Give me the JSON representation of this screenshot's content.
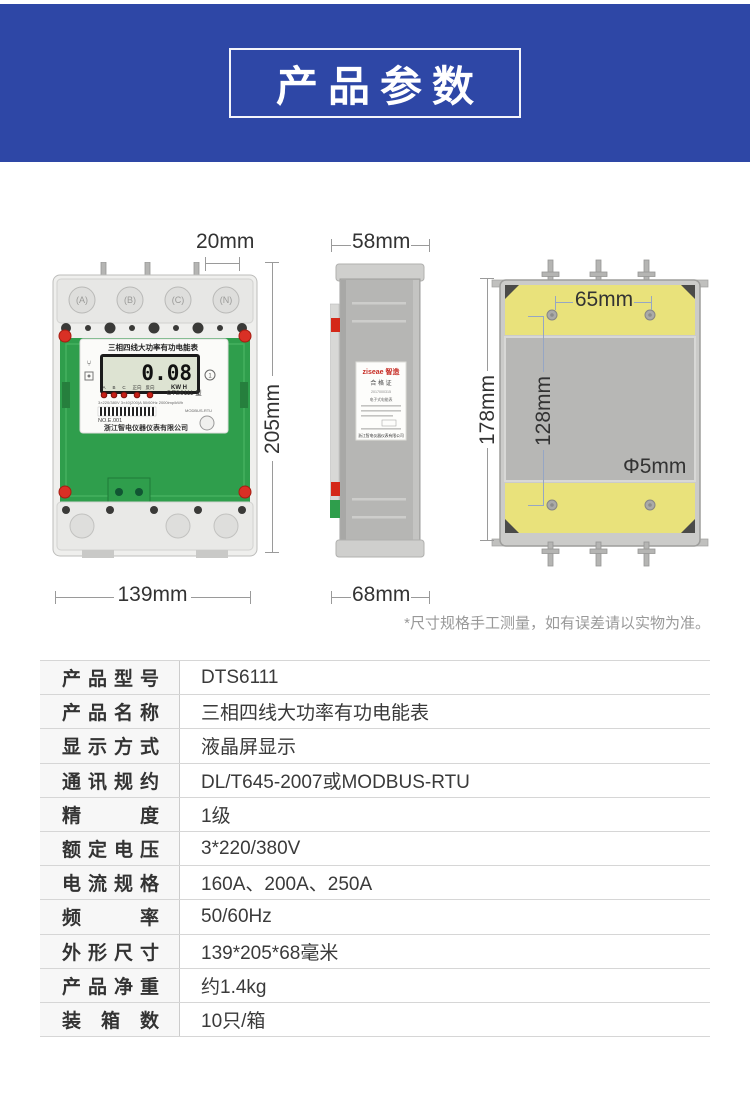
{
  "header": {
    "title": "产品参数",
    "bg_color": "#2e47a6"
  },
  "diagram": {
    "front_view": {
      "terminal_labels": [
        "A",
        "B",
        "C",
        "N"
      ],
      "meter_title": "三相四线大功率有功电能表",
      "lcd_value": "0.08",
      "lcd_unit": "KW H",
      "register_badge": "1",
      "indicator_labels": [
        "A",
        "B",
        "C",
        "正向",
        "反向"
      ],
      "model_label": "DTS6111 型",
      "spec_line": "3×220/380V 3×40(200)A 50/60Hz 2000imp/kWh",
      "comm_line": "MODBUS-RTU",
      "serial_no": "NO.E.001",
      "company": "浙江智电仪器仪表有限公司"
    },
    "side_view": {
      "brand": "ziseae 智造",
      "cert_title": "合 格 证",
      "cert_no": "2017000315",
      "cert_item": "电子式电能表",
      "cert_company": "浙江智电仪器仪表有限公司"
    },
    "dimensions": {
      "top_pitch": "20mm",
      "depth_body": "58mm",
      "hole_pitch_h": "65mm",
      "height_front": "205mm",
      "height_back": "178mm",
      "hole_pitch_v": "128mm",
      "hole_dia": "Φ5mm",
      "width_front": "139mm",
      "depth_base": "68mm"
    },
    "note": "*尺寸规格手工测量，如有误差请以实物为准。"
  },
  "spec_table": {
    "rows": [
      {
        "label": "产品型号",
        "value": "DTS6111"
      },
      {
        "label": "产品名称",
        "value": "三相四线大功率有功电能表"
      },
      {
        "label": "显示方式",
        "value": "液晶屏显示"
      },
      {
        "label": "通讯规约",
        "value": "DL/T645-2007或MODBUS-RTU"
      },
      {
        "label": "精度",
        "value": "1级"
      },
      {
        "label": "额定电压",
        "value": "3*220/380V"
      },
      {
        "label": "电流规格",
        "value": "160A、200A、250A"
      },
      {
        "label": "频率",
        "value": "50/60Hz"
      },
      {
        "label": "外形尺寸",
        "value": "139*205*68毫米"
      },
      {
        "label": "产品净重",
        "value": "约1.4kg"
      },
      {
        "label": "装箱数",
        "value": "10只/箱"
      }
    ]
  },
  "colors": {
    "banner_blue": "#2e47a6",
    "mount_yellow": "#e9e27b",
    "pcb_green": "#2f9e4c",
    "screw_red": "#d93025"
  }
}
